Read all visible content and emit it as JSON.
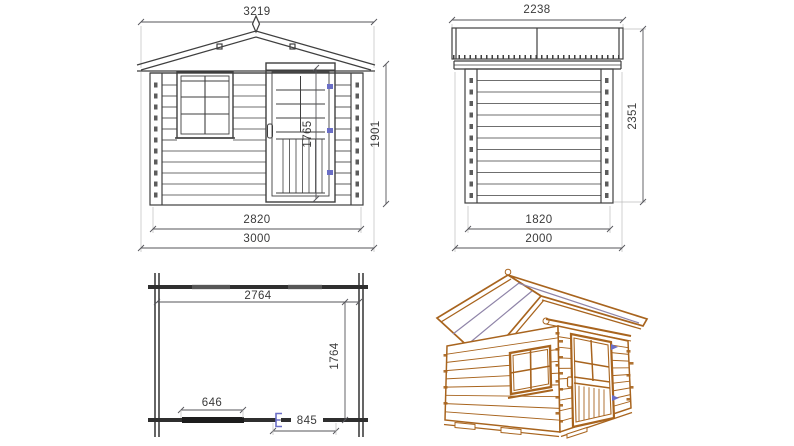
{
  "document": {
    "title": "Log cabin garden shed technical drawing",
    "views": [
      "front elevation",
      "side elevation",
      "floor plan",
      "3d perspective"
    ]
  },
  "views": {
    "front": {
      "label": "front-elevation",
      "dim_overall_width": "3219",
      "dim_wall_height": "1901",
      "dim_door_height": "1765",
      "dim_wall_width": "2820",
      "dim_overall_base": "3000"
    },
    "side": {
      "label": "side-elevation",
      "dim_overall_depth": "2238",
      "dim_overall_height": "2351",
      "dim_wall_depth": "1820",
      "dim_overall_base": "2000"
    },
    "plan": {
      "label": "floor-plan",
      "dim_inner_width": "2764",
      "dim_inner_depth": "1764",
      "dim_window_width": "646",
      "dim_door_width": "845"
    },
    "perspective": {
      "label": "3d-perspective-view"
    }
  },
  "colors": {
    "line": "#3f3f3f",
    "dimension": "#55555a",
    "cabin_brown": "#a8641e",
    "roof_accent": "#8f84a8",
    "hinge_blue": "#6a6ec6",
    "background": "#ffffff"
  }
}
